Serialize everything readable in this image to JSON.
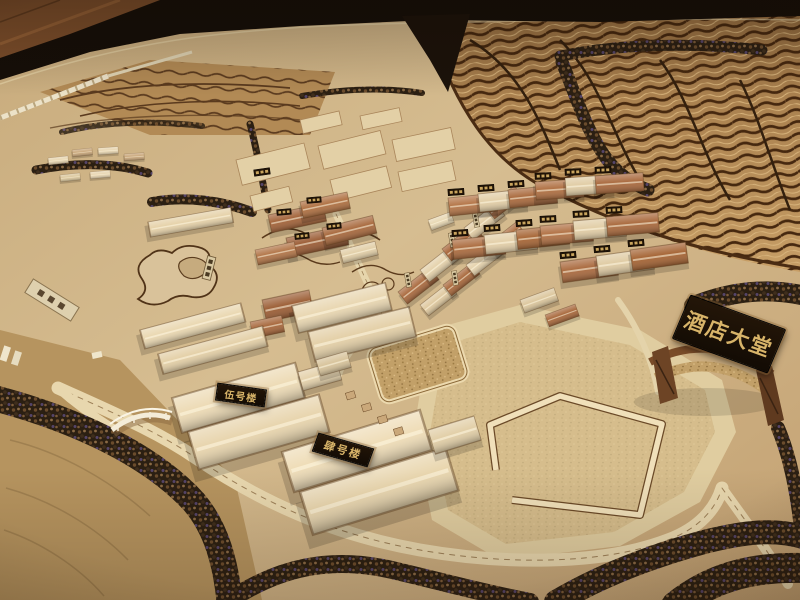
{
  "photo": {
    "type": "photograph",
    "subject": "Wooden architectural scale model (sand table) of a hillside hotel resort campus with terraced slopes, tree belts, roads, a lake, building clusters and labeled plaques",
    "signs": {
      "hotel_lobby": "酒店大堂",
      "building_5": "伍号楼",
      "building_4": "肆号楼"
    },
    "colors": {
      "terrain_wood": "#d2b88c",
      "terrace_contour": "#46280f",
      "building_light_wood": "#ecd9b4",
      "building_red_cork": "#a4653c",
      "plaque_background": "#201306",
      "plaque_gold_text": "#d8b469",
      "tree_foliage": "#3a2a1a",
      "room_background": "#150e08"
    }
  }
}
